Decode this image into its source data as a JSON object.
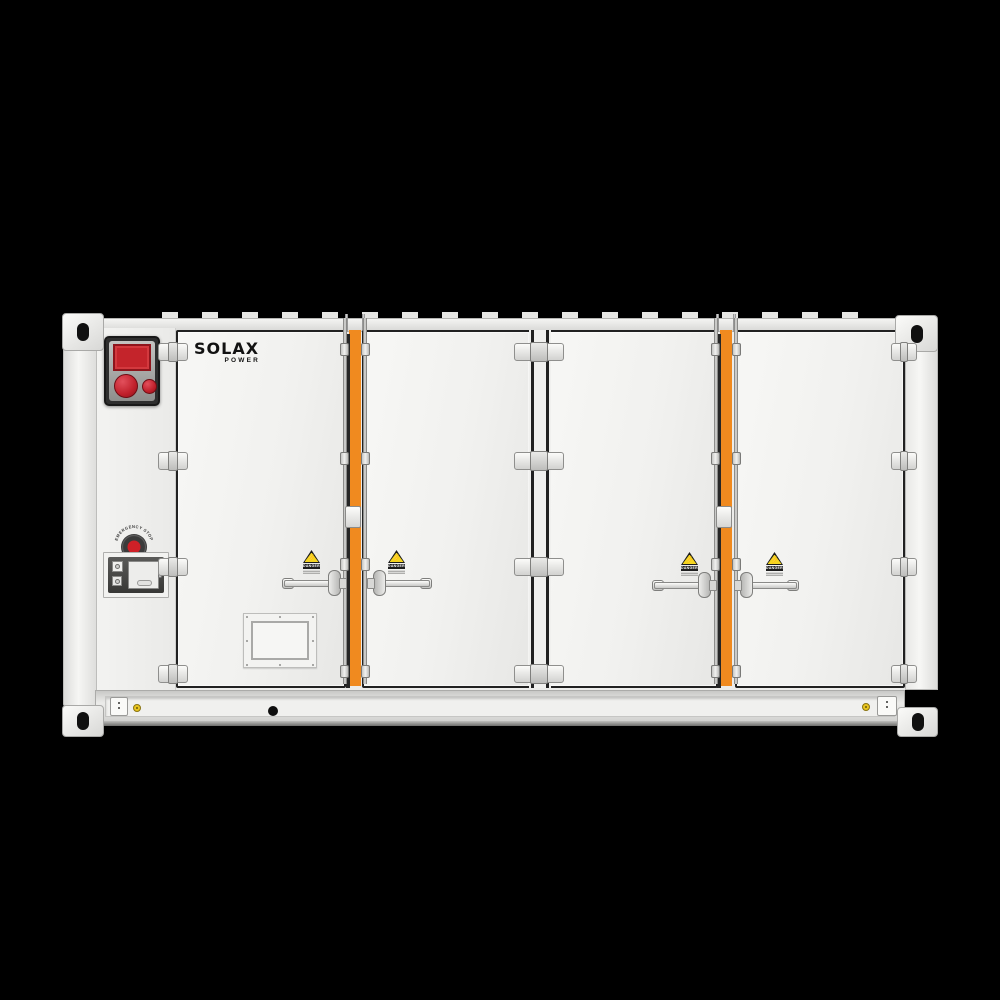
{
  "scene": {
    "background": "#000000"
  },
  "brand": {
    "name": "SOLAX",
    "sub": "POWER"
  },
  "labels": {
    "emergency_stop": "EMERGENCY STOP",
    "danger": "DANGER"
  },
  "icons": {
    "lightning_glyph": "⚡"
  },
  "colors": {
    "body_white": "#F1F1EF",
    "accent_orange": "#F08A1F",
    "gasket_black": "#212121",
    "alarm_red": "#C4242B",
    "button_red": "#C0202B",
    "sticker_yellow": "#E9C51F",
    "warning_yellow": "#F5D520"
  }
}
